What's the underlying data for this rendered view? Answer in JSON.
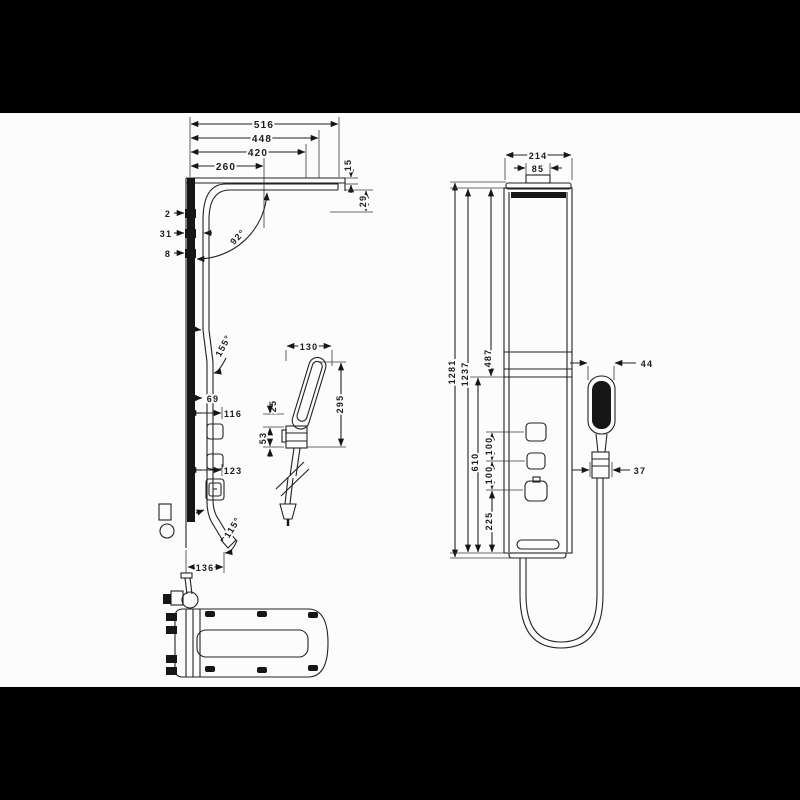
{
  "title": "Shower panel technical dimension drawing",
  "colors": {
    "bars": "#000000",
    "canvas": "#fcfcfc",
    "line": "#222222",
    "fill": "#161616"
  },
  "labels": {
    "side": {
      "w516": "516",
      "w448": "448",
      "w420": "420",
      "w260": "260",
      "t15": "15",
      "t29": "29",
      "o2": "2",
      "o31": "31",
      "o8": "8",
      "a92": "92°",
      "a155": "155°",
      "a115": "115°",
      "h69": "69",
      "h116": "116",
      "h123": "123",
      "w136": "136"
    },
    "detail": {
      "w130": "130",
      "h295": "295",
      "h25": "25",
      "h53": "53"
    },
    "front": {
      "w214": "214",
      "w85": "85",
      "h1281": "1281",
      "h1237": "1237",
      "h487": "487",
      "h610": "610",
      "s100a": "100",
      "s100b": "100",
      "h225": "225",
      "w44": "44",
      "w37": "37"
    }
  }
}
